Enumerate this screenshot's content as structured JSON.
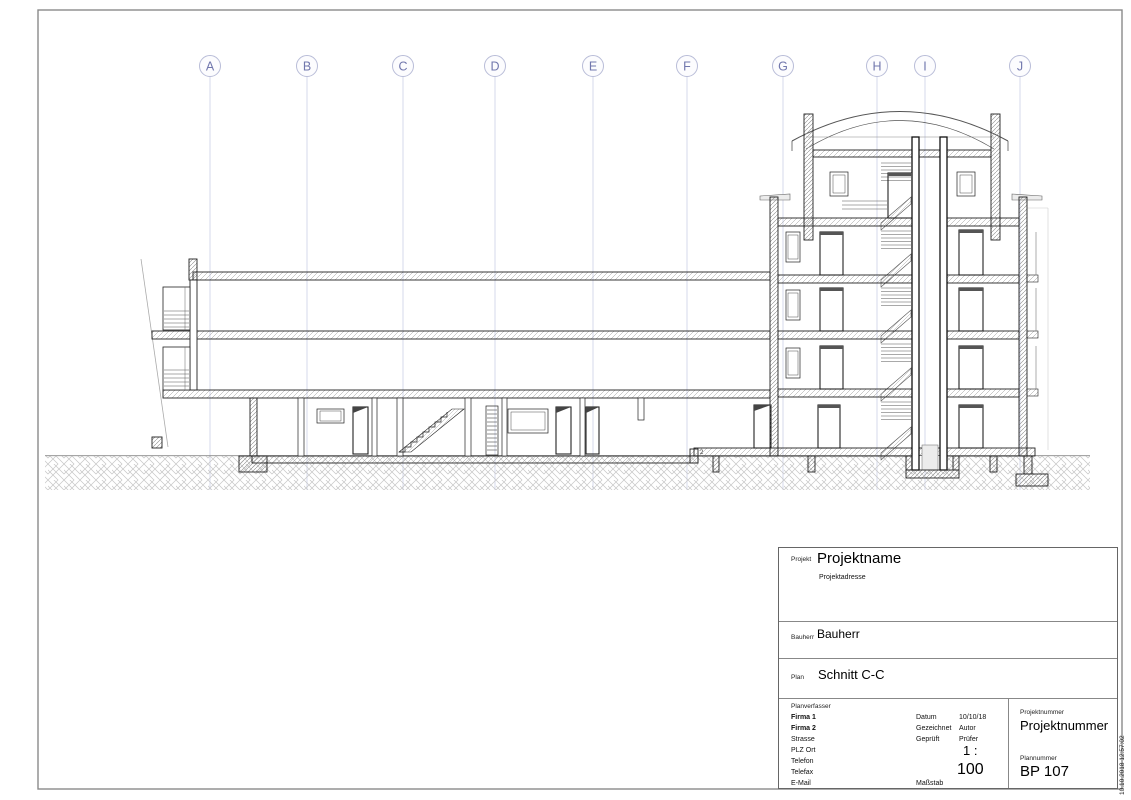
{
  "sheet": {
    "grid_labels": [
      "A",
      "B",
      "C",
      "D",
      "E",
      "F",
      "G",
      "H",
      "I",
      "J"
    ],
    "step_annotation": "2"
  },
  "title_block": {
    "project": {
      "label": "Projekt",
      "name": "Projektname",
      "address": "Projektadresse"
    },
    "client": {
      "label": "Bauherr",
      "name": "Bauherr"
    },
    "plan": {
      "label": "Plan",
      "name": "Schnitt C-C"
    },
    "author_block": {
      "label": "Planverfasser",
      "line1": "Firma 1",
      "line2": "Firma 2",
      "line3": "Strasse",
      "line4": "PLZ Ort",
      "line5": "Telefon",
      "line6": "Telefax",
      "line7": "E-Mail"
    },
    "meta": {
      "date_label": "Datum",
      "date": "10/10/18",
      "drawn_label": "Gezeichnet",
      "drawn": "Autor",
      "checked_label": "Geprüft",
      "checked": "Prüfer",
      "scale_label": "Maßstab",
      "scale_prefix": "1 :",
      "scale_value": "100"
    },
    "project_number": {
      "label": "Projektnummer",
      "value": "Projektnummer"
    },
    "plan_number": {
      "label": "Plannummer",
      "value": "BP 107"
    }
  },
  "timestamp": "10.10.2018 12:57:02",
  "colors": {
    "grid_line": "#ccd0e6",
    "grid_letter": "#7177ad",
    "cut_line": "#222222",
    "hatch": "#9a9a9a",
    "ground_hatch": "#c2c2c2",
    "border": "#8a8a8a"
  }
}
